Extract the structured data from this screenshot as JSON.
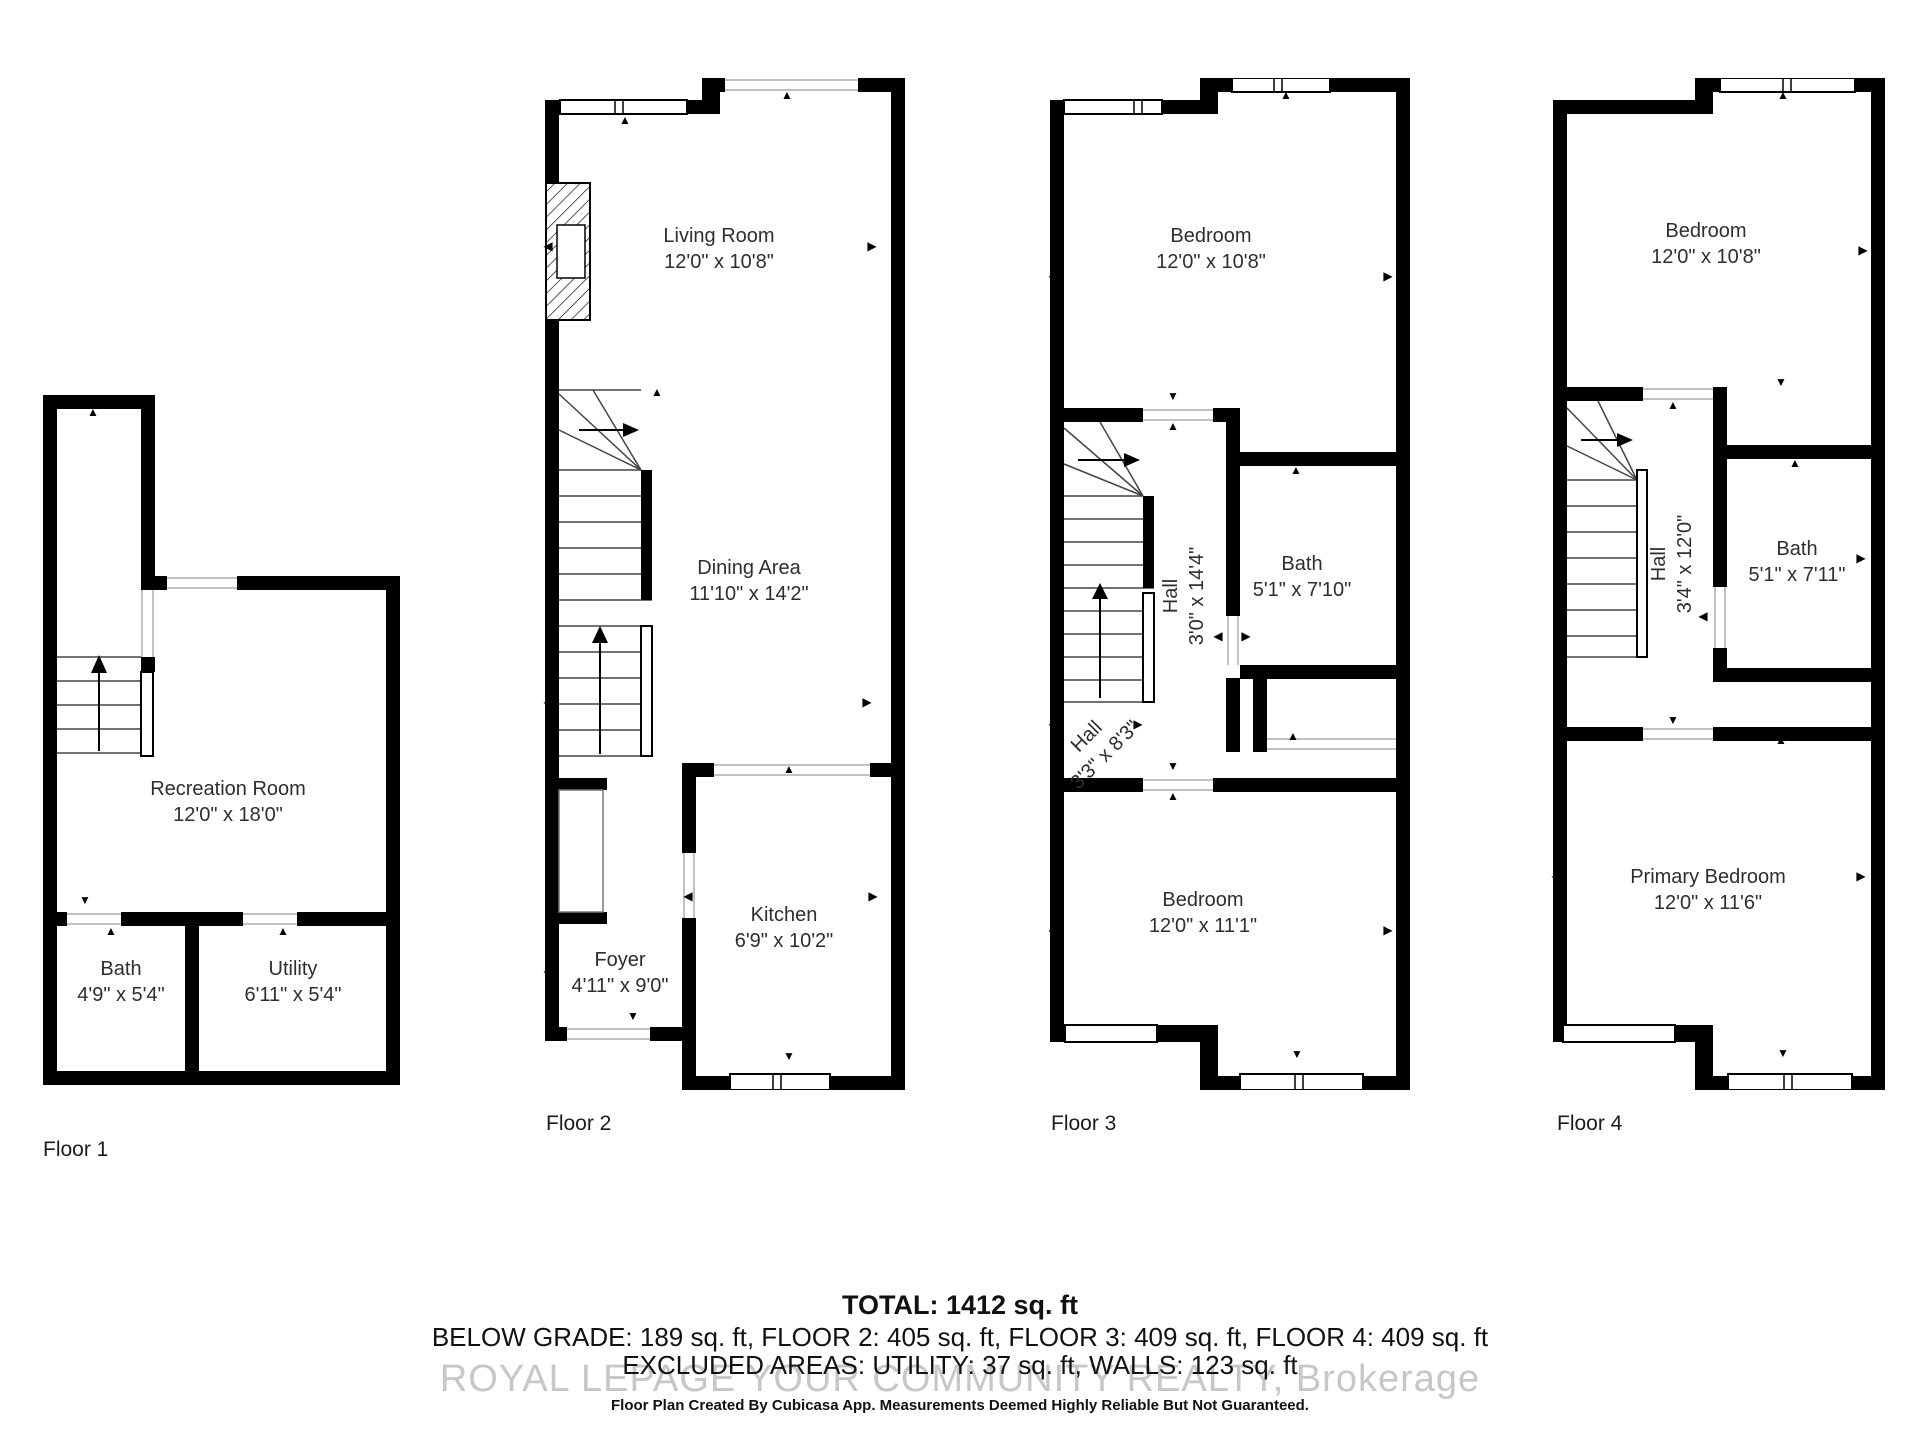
{
  "glyphs": {
    "up": "▲",
    "down": "▼",
    "left": "◀",
    "right": "▶"
  },
  "colors": {
    "wall": "#000000",
    "text": "#2e2e2e",
    "watermark": "#c7c7c7",
    "opening_line": "#c2c2c2"
  },
  "floors": [
    {
      "label": "Floor 1",
      "rooms": {
        "recreation": {
          "name": "Recreation Room",
          "dims": "12'0\" x 18'0\""
        },
        "bath": {
          "name": "Bath",
          "dims": "4'9\" x 5'4\""
        },
        "utility": {
          "name": "Utility",
          "dims": "6'11\" x 5'4\""
        }
      }
    },
    {
      "label": "Floor 2",
      "rooms": {
        "living": {
          "name": "Living Room",
          "dims": "12'0\" x 10'8\""
        },
        "dining": {
          "name": "Dining Area",
          "dims": "11'10\" x 14'2\""
        },
        "kitchen": {
          "name": "Kitchen",
          "dims": "6'9\" x 10'2\""
        },
        "foyer": {
          "name": "Foyer",
          "dims": "4'11\" x 9'0\""
        }
      }
    },
    {
      "label": "Floor 3",
      "rooms": {
        "bedroom_top": {
          "name": "Bedroom",
          "dims": "12'0\" x 10'8\""
        },
        "hall_upper": {
          "name": "Hall",
          "dims": "3'0\" x 14'4\""
        },
        "bath": {
          "name": "Bath",
          "dims": "5'1\" x 7'10\""
        },
        "hall_lower": {
          "name": "Hall",
          "dims": "3'3\" x 8'3\""
        },
        "bedroom_bottom": {
          "name": "Bedroom",
          "dims": "12'0\" x 11'1\""
        }
      }
    },
    {
      "label": "Floor 4",
      "rooms": {
        "bedroom": {
          "name": "Bedroom",
          "dims": "12'0\" x 10'8\""
        },
        "hall": {
          "name": "Hall",
          "dims": "3'4\" x 12'0\""
        },
        "bath": {
          "name": "Bath",
          "dims": "5'1\" x 7'11\""
        },
        "primary": {
          "name": "Primary Bedroom",
          "dims": "12'0\" x 11'6\""
        }
      }
    }
  ],
  "summary": {
    "total": "TOTAL: 1412 sq. ft",
    "breakdown": "BELOW GRADE: 189 sq. ft, FLOOR 2: 405 sq. ft, FLOOR 3: 409 sq. ft, FLOOR 4: 409 sq. ft",
    "excluded": "EXCLUDED AREAS: UTILITY: 37 sq. ft, WALLS: 123 sq. ft",
    "watermark": "ROYAL LEPAGE YOUR COMMUNITY REALTY, Brokerage",
    "disclaimer": "Floor Plan Created By Cubicasa App. Measurements Deemed Highly Reliable But Not Guaranteed."
  }
}
